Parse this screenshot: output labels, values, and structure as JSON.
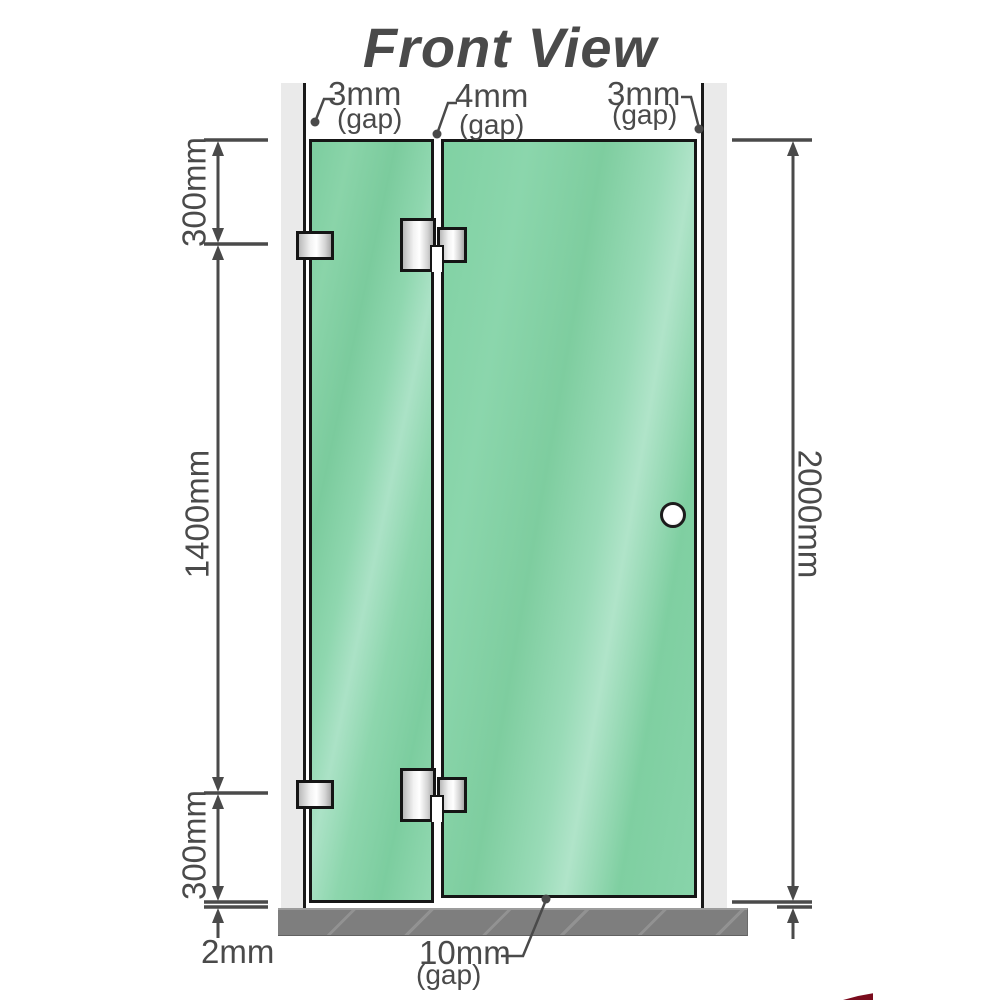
{
  "title": "Front View",
  "labels": {
    "gap_top_left": {
      "value": "3mm",
      "note": "(gap)"
    },
    "gap_top_middle": {
      "value": "4mm",
      "note": "(gap)"
    },
    "gap_top_right": {
      "value": "3mm",
      "note": "(gap)"
    },
    "gap_bottom": {
      "value": "10mm",
      "note": "(gap)"
    },
    "dim_top_segment": "300mm",
    "dim_middle_segment": "1400mm",
    "dim_bottom_segment": "300mm",
    "dim_floor_gap": "2mm",
    "dim_total_height": "2000mm"
  },
  "colors": {
    "glass_green": "#7fcfa1",
    "glass_highlight": "#abe2c6",
    "wall_gray": "#eaeaea",
    "floor_gray": "#7e7e7e",
    "outline_black": "#161616",
    "dimension_line": "#4a4a4a",
    "title_gray": "#a5a5a5",
    "hardware_metal": "#e9e9e9",
    "logo_red": "#7a0c1d"
  }
}
